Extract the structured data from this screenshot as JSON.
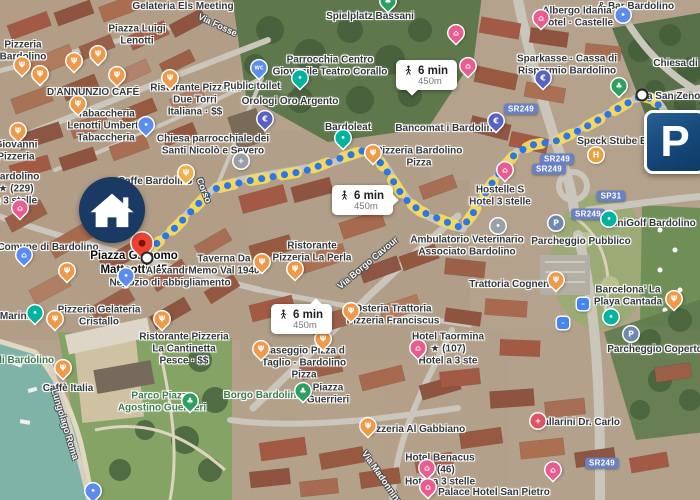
{
  "parking_sign": {
    "letter": "P"
  },
  "route": {
    "badges": [
      {
        "time": "6 min",
        "distance": "450m",
        "x": 396,
        "y": 60,
        "cls": "t-down"
      },
      {
        "time": "6 min",
        "distance": "450m",
        "x": 332,
        "y": 185,
        "cls": "t-right"
      },
      {
        "time": "6 min",
        "distance": "450m",
        "x": 271,
        "y": 304,
        "cls": "t-up"
      }
    ]
  },
  "road_shields": [
    {
      "text": "SR249",
      "x": 521,
      "y": 109
    },
    {
      "text": "SR249",
      "x": 557,
      "y": 159
    },
    {
      "text": "SR249",
      "x": 549,
      "y": 169
    },
    {
      "text": "SP31",
      "x": 611,
      "y": 196
    },
    {
      "text": "SR249",
      "x": 588,
      "y": 214
    },
    {
      "text": "SR249",
      "x": 602,
      "y": 463
    }
  ],
  "street_labels": [
    {
      "text": "Via Fosse",
      "x": 218,
      "y": 24,
      "rotate": 25
    },
    {
      "text": "Corso",
      "x": 205,
      "y": 190,
      "rotate": 68
    },
    {
      "text": "Via Borgo Cavour",
      "x": 367,
      "y": 262,
      "rotate": -40
    },
    {
      "text": "Lungolago Roma",
      "x": 66,
      "y": 424,
      "rotate": 73
    },
    {
      "text": "Via Madonnina",
      "x": 383,
      "y": 477,
      "rotate": 55
    }
  ],
  "labels": [
    {
      "text": "Gelateria Els Meeting",
      "x": 183,
      "y": 5
    },
    {
      "text": "Piazza Luigi\nLenotti",
      "x": 137,
      "y": 36
    },
    {
      "text": "Pizzeria\nBardolino",
      "x": 23,
      "y": 52
    },
    {
      "text": "D'ANNUNZIO CAFÉ",
      "x": 93,
      "y": 91
    },
    {
      "text": "Ristorante Pizzeria\nDue Torri\nItaliana · $$",
      "x": 195,
      "y": 101
    },
    {
      "text": "Tabaccheria\nLenotti Umberto\nTabaccheria",
      "x": 106,
      "y": 127
    },
    {
      "text": "Chiesa parrocchiale dei\nSanti Nicolò e Severo",
      "x": 213,
      "y": 146
    },
    {
      "text": "Giovanni\nPizzeria",
      "x": 16,
      "y": 152
    },
    {
      "text": "Spielplatz Bassani",
      "x": 370,
      "y": 15
    },
    {
      "text": "Parrocchia Centro\nGiovanile Teatro Corallo",
      "x": 330,
      "y": 67
    },
    {
      "text": "Public toilet",
      "x": 252,
      "y": 85
    },
    {
      "text": "Orologi Oro Argento",
      "x": 290,
      "y": 100
    },
    {
      "text": "Bardoleat",
      "x": 348,
      "y": 126
    },
    {
      "text": "Bancomat i Bardolino",
      "x": 447,
      "y": 127
    },
    {
      "text": "Pizzeria Bardolino\nPizza",
      "x": 419,
      "y": 158
    },
    {
      "text": "& Bar Bardolino",
      "x": 636,
      "y": 5
    },
    {
      "text": "Albergo Idania\nHotel · Castelle",
      "x": 577,
      "y": 18
    },
    {
      "text": "Chiesa di Sa",
      "x": 683,
      "y": 62
    },
    {
      "text": "Sparkasse · Cassa di\nRisparmio Bardolino",
      "x": 567,
      "y": 66
    },
    {
      "text": "Via San Zeno",
      "x": 669,
      "y": 95
    },
    {
      "text": "Speck Stube Ba",
      "x": 615,
      "y": 140
    },
    {
      "text": "Hostelle S\nHotel 3 stelle",
      "x": 500,
      "y": 197
    },
    {
      "text": "Caffe Bardolino",
      "x": 155,
      "y": 180
    },
    {
      "text": "Bardolino\n★ (229)\na 3 stelle",
      "x": 16,
      "y": 190
    },
    {
      "text": "Comune di Bardolino",
      "x": 48,
      "y": 246
    },
    {
      "text": "Piazza Giacomo\nMatteotti, 45",
      "x": 134,
      "y": 264,
      "cls": "dest"
    },
    {
      "text": "Alexandra\nNegozio di abbigliamento",
      "x": 170,
      "y": 278
    },
    {
      "text": "Taverna Da\nMemo Val 1940",
      "x": 224,
      "y": 266
    },
    {
      "text": "Ristorante\nPizzeria La Perla",
      "x": 312,
      "y": 253
    },
    {
      "text": "Ambulatorio Veterinario\nAssociato Bardolino",
      "x": 467,
      "y": 247
    },
    {
      "text": "Trattoria Cognento",
      "x": 514,
      "y": 283
    },
    {
      "text": "Parcheggio Pubblico",
      "x": 581,
      "y": 240
    },
    {
      "text": "MiniGolf Bardolino",
      "x": 651,
      "y": 222
    },
    {
      "text": "Barcelona' La\nPlaya Cantada",
      "x": 628,
      "y": 297
    },
    {
      "text": "Parcheggio Coperto",
      "x": 655,
      "y": 348
    },
    {
      "text": "Marina",
      "x": 16,
      "y": 315
    },
    {
      "text": "Pizzeria Gelateria\nCristallo",
      "x": 99,
      "y": 317
    },
    {
      "text": "Osteria Trattoria\nPizzeria Franciscus",
      "x": 393,
      "y": 316
    },
    {
      "text": "di Bardolino",
      "x": 25,
      "y": 359,
      "cls": "green"
    },
    {
      "text": "Ristorante Pizzeria\nLa Cantinetta\nPesce · $$",
      "x": 184,
      "y": 350
    },
    {
      "text": "Caffè Italia",
      "x": 68,
      "y": 387
    },
    {
      "text": "Parco Piazza\nAgostino Guerrieri",
      "x": 162,
      "y": 403,
      "cls": "green"
    },
    {
      "text": "Borgo Bardolino",
      "x": 263,
      "y": 394,
      "cls": "green"
    },
    {
      "text": "Piazza\nGuerrieri",
      "x": 328,
      "y": 395
    },
    {
      "text": "Baseggio Pizza d\nTaglio - Bardolino\nPizza",
      "x": 304,
      "y": 364
    },
    {
      "text": "Hotel Taormina\n★ (107)\nHotel a 3 ste",
      "x": 448,
      "y": 350
    },
    {
      "text": "Pizzeria Al Gabbiano",
      "x": 416,
      "y": 428
    },
    {
      "text": "Ballarini Dr. Carlo",
      "x": 578,
      "y": 421
    },
    {
      "text": "Hotel Benacus\n★ (46)\nHotel a 3 stelle",
      "x": 440,
      "y": 471
    },
    {
      "text": "Palace Hotel San Pietro",
      "x": 494,
      "y": 491
    }
  ],
  "pins": [
    {
      "glyph": "Ψ",
      "color": "#ef9a4a",
      "x": 22,
      "y": 67
    },
    {
      "glyph": "Ψ",
      "color": "#ef9a4a",
      "x": 40,
      "y": 76
    },
    {
      "glyph": "Ψ",
      "color": "#ef9a4a",
      "x": 74,
      "y": 63
    },
    {
      "glyph": "Ψ",
      "color": "#ef9a4a",
      "x": 98,
      "y": 56
    },
    {
      "glyph": "Ψ",
      "color": "#ef9a4a",
      "x": 117,
      "y": 77
    },
    {
      "glyph": "Ψ",
      "color": "#ef9a4a",
      "x": 170,
      "y": 80
    },
    {
      "glyph": "Ψ",
      "color": "#ef9a4a",
      "x": 78,
      "y": 106
    },
    {
      "glyph": "Ψ",
      "color": "#ef9a4a",
      "x": 18,
      "y": 133
    },
    {
      "glyph": "Ψ",
      "color": "#efb24a",
      "x": 186,
      "y": 175
    },
    {
      "glyph": "Ψ",
      "color": "#ef9a4a",
      "x": 373,
      "y": 155
    },
    {
      "glyph": "Ψ",
      "color": "#ef9a4a",
      "x": 262,
      "y": 264
    },
    {
      "glyph": "Ψ",
      "color": "#ef9a4a",
      "x": 295,
      "y": 271
    },
    {
      "glyph": "Ψ",
      "color": "#ef9a4a",
      "x": 351,
      "y": 313
    },
    {
      "glyph": "Ψ",
      "color": "#ef9a4a",
      "x": 63,
      "y": 370
    },
    {
      "glyph": "Ψ",
      "color": "#ef9a4a",
      "x": 261,
      "y": 351
    },
    {
      "glyph": "Ψ",
      "color": "#ef9a4a",
      "x": 323,
      "y": 341
    },
    {
      "glyph": "Ψ",
      "color": "#ef9a4a",
      "x": 368,
      "y": 428
    },
    {
      "glyph": "Ψ",
      "color": "#ef9a4a",
      "x": 556,
      "y": 282
    },
    {
      "glyph": "Ψ",
      "color": "#ef9a4a",
      "x": 55,
      "y": 321
    },
    {
      "glyph": "Ψ",
      "color": "#ef9a4a",
      "x": 162,
      "y": 321
    },
    {
      "glyph": "Ψ",
      "color": "#ef9a4a",
      "x": 674,
      "y": 301
    },
    {
      "glyph": "Ψ",
      "color": "#ef9a4a",
      "x": 67,
      "y": 273
    },
    {
      "glyph": "⌂",
      "color": "#e85c90",
      "x": 20,
      "y": 210
    },
    {
      "glyph": "⌂",
      "color": "#e85c90",
      "x": 456,
      "y": 35
    },
    {
      "glyph": "⌂",
      "color": "#e85c90",
      "x": 468,
      "y": 68
    },
    {
      "glyph": "⌂",
      "color": "#e85c90",
      "x": 505,
      "y": 172
    },
    {
      "glyph": "⌂",
      "color": "#e85c90",
      "x": 541,
      "y": 20
    },
    {
      "glyph": "⌂",
      "color": "#e85c90",
      "x": 418,
      "y": 350
    },
    {
      "glyph": "⌂",
      "color": "#e85c90",
      "x": 427,
      "y": 470
    },
    {
      "glyph": "⌂",
      "color": "#e85c90",
      "x": 428,
      "y": 489
    },
    {
      "glyph": "⌂",
      "color": "#e85c90",
      "x": 553,
      "y": 472
    },
    {
      "glyph": "•",
      "color": "#5b8def",
      "x": 146,
      "y": 127
    },
    {
      "glyph": "•",
      "color": "#5b8def",
      "x": 126,
      "y": 278
    },
    {
      "glyph": "•",
      "color": "#5b8def",
      "x": 93,
      "y": 493
    },
    {
      "glyph": "WC",
      "color": "#5b8def",
      "x": 259,
      "y": 70,
      "glyph_size": 5
    },
    {
      "glyph": "⌂",
      "color": "#5b8def",
      "x": 24,
      "y": 257
    },
    {
      "glyph": "•",
      "color": "#5b8def",
      "x": 623,
      "y": 15,
      "cls": "circ"
    },
    {
      "glyph": "€",
      "color": "#5663c0",
      "x": 543,
      "y": 80
    },
    {
      "glyph": "€",
      "color": "#5663c0",
      "x": 496,
      "y": 123
    },
    {
      "glyph": "€",
      "color": "#5663c0",
      "x": 265,
      "y": 121
    },
    {
      "glyph": "•",
      "color": "#00b2a0",
      "x": 300,
      "y": 80
    },
    {
      "glyph": "•",
      "color": "#00b2a0",
      "x": 343,
      "y": 140
    },
    {
      "glyph": "•",
      "color": "#00b2a0",
      "x": 35,
      "y": 315
    },
    {
      "glyph": "•",
      "color": "#00b2a0",
      "x": 609,
      "y": 219,
      "cls": "circ"
    },
    {
      "glyph": "•",
      "color": "#00b2a0",
      "x": 611,
      "y": 317,
      "cls": "circ"
    },
    {
      "glyph": "♣",
      "color": "#2f9e63",
      "x": 388,
      "y": 3
    },
    {
      "glyph": "♣",
      "color": "#2f9e63",
      "x": 619,
      "y": 88
    },
    {
      "glyph": "♣",
      "color": "#2f9e63",
      "x": 190,
      "y": 403
    },
    {
      "glyph": "♣",
      "color": "#2f9e63",
      "x": 303,
      "y": 393
    },
    {
      "glyph": "P",
      "color": "#6f88ae",
      "x": 556,
      "y": 223,
      "cls": "circ"
    },
    {
      "glyph": "P",
      "color": "#6f88ae",
      "x": 631,
      "y": 334,
      "cls": "circ"
    },
    {
      "glyph": "–",
      "color": "#4285f4",
      "x": 583,
      "y": 304,
      "cls": "sq"
    },
    {
      "glyph": "–",
      "color": "#4285f4",
      "x": 563,
      "y": 323,
      "cls": "sq"
    },
    {
      "glyph": "+",
      "color": "#e05267",
      "x": 538,
      "y": 421,
      "cls": "circ"
    },
    {
      "glyph": "+",
      "color": "#98a0a8",
      "x": 241,
      "y": 161,
      "cls": "circ"
    },
    {
      "glyph": "•",
      "color": "#98a0a8",
      "x": 498,
      "y": 226,
      "cls": "circ"
    },
    {
      "glyph": "H",
      "color": "#e8a23c",
      "x": 596,
      "y": 155,
      "cls": "circ"
    },
    {
      "glyph": "●",
      "color": "#ea4335",
      "x": 142,
      "y": 246,
      "cls": "big"
    },
    {
      "glyph": "",
      "color": "#ffffff",
      "x": 147,
      "y": 258,
      "cls": "dotp"
    },
    {
      "glyph": "",
      "color": "#ffffff",
      "x": 642,
      "y": 95,
      "cls": "dotp"
    }
  ]
}
